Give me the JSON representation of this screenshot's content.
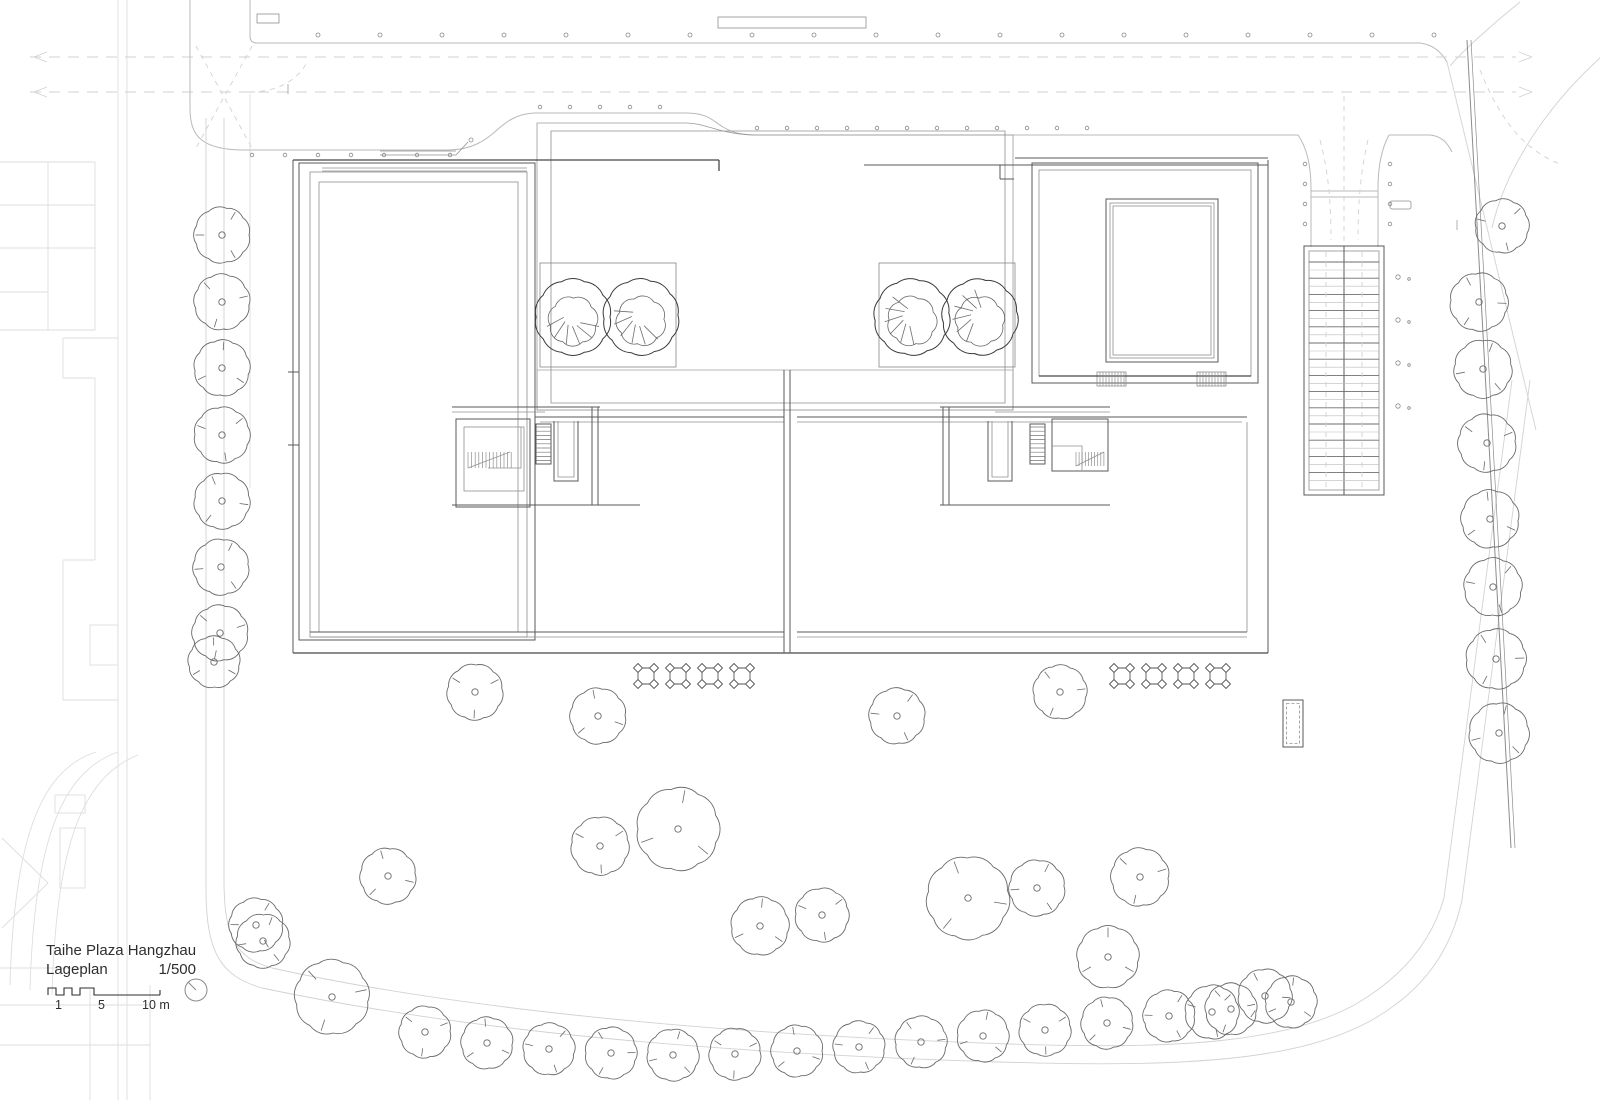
{
  "title_block": {
    "project": "Taihe Plaza Hangzhau",
    "drawing": "Lageplan",
    "scale": "1/500",
    "scale_ticks": [
      "1",
      "5",
      "10 m"
    ]
  },
  "colors": {
    "line_dark": "#5a5a5a",
    "line_mid": "#909090",
    "line_light": "#b9b9b9",
    "hatch_light": "#c6c6c6",
    "hatch_mid": "#9a9a9a",
    "panel_fill": "#b0b0b0",
    "band_fill": "#d7d7d7",
    "band_strip": "#eaeaea",
    "tree_line": "#6a6a6a",
    "tree_dark": "#474747",
    "tree_mid": "#8f8f8f",
    "dot": "#8a8a8a",
    "text": "#2e2e2e"
  },
  "site_plan": {
    "trees": {
      "street_left": [
        [
          222,
          235,
          27
        ],
        [
          222,
          302,
          27
        ],
        [
          222,
          368,
          27
        ],
        [
          222,
          435,
          27
        ],
        [
          222,
          501,
          27
        ],
        [
          221,
          567,
          27
        ],
        [
          220,
          633,
          27
        ],
        [
          214,
          662,
          25
        ]
      ],
      "street_right": [
        [
          1502,
          226,
          26
        ],
        [
          1479,
          302,
          28
        ],
        [
          1483,
          369,
          28
        ],
        [
          1487,
          443,
          28
        ],
        [
          1490,
          519,
          28
        ],
        [
          1493,
          587,
          28
        ],
        [
          1496,
          659,
          29
        ],
        [
          1499,
          733,
          29
        ]
      ],
      "scatter": [
        [
          475,
          692,
          27
        ],
        [
          598,
          716,
          27
        ],
        [
          897,
          716,
          27
        ],
        [
          1060,
          692,
          26
        ],
        [
          678,
          829,
          40
        ],
        [
          600,
          846,
          28
        ],
        [
          388,
          876,
          27
        ],
        [
          256,
          925,
          26
        ],
        [
          332,
          997,
          36
        ],
        [
          760,
          926,
          28
        ],
        [
          822,
          915,
          26
        ],
        [
          968,
          898,
          40
        ],
        [
          1037,
          888,
          27
        ],
        [
          1140,
          877,
          28
        ],
        [
          1108,
          957,
          30
        ],
        [
          1212,
          1012,
          26
        ],
        [
          1265,
          996,
          26
        ],
        [
          263,
          941,
          26
        ]
      ],
      "bottom_row": [
        [
          425,
          1032,
          25
        ],
        [
          487,
          1043,
          25
        ],
        [
          549,
          1049,
          25
        ],
        [
          611,
          1053,
          25
        ],
        [
          673,
          1055,
          25
        ],
        [
          735,
          1054,
          25
        ],
        [
          797,
          1051,
          25
        ],
        [
          859,
          1047,
          25
        ],
        [
          921,
          1042,
          25
        ],
        [
          983,
          1036,
          25
        ],
        [
          1045,
          1030,
          25
        ],
        [
          1107,
          1023,
          25
        ],
        [
          1169,
          1016,
          25
        ],
        [
          1231,
          1009,
          25
        ],
        [
          1291,
          1002,
          25
        ]
      ],
      "courtyard_dark": [
        [
          573,
          317,
          37
        ],
        [
          641,
          317,
          37
        ],
        [
          912,
          317,
          37
        ],
        [
          980,
          317,
          37
        ]
      ]
    },
    "planting_markers": {
      "y": 676,
      "x_positions": [
        646,
        678,
        710,
        742,
        1122,
        1154,
        1186,
        1218
      ]
    },
    "dot_rows": [
      {
        "y": 35,
        "x0": 318,
        "x1": 1442,
        "step": 62,
        "r": 2
      },
      {
        "y": 155,
        "x0": 252,
        "x1": 450,
        "step": 33,
        "r": 1.8
      },
      {
        "y": 107,
        "x0": 540,
        "x1": 688,
        "step": 30,
        "r": 1.8
      },
      {
        "y": 128,
        "x0": 757,
        "x1": 1097,
        "step": 30,
        "r": 1.8
      },
      {
        "y": 820,
        "x0": 237,
        "x1": 1272,
        "step": 23,
        "r": 1.2,
        "fill": 1
      }
    ],
    "dot_cols": [
      {
        "x": 1305,
        "y0": 164,
        "y1": 226,
        "step": 20,
        "r": 1.8
      },
      {
        "x": 1390,
        "y0": 164,
        "y1": 226,
        "step": 20,
        "r": 1.8
      },
      {
        "x": 1398,
        "y0": 277,
        "y1": 408,
        "step": 43,
        "r": 2.2
      },
      {
        "x": 1409,
        "y0": 279,
        "y1": 410,
        "step": 43,
        "r": 1.3
      }
    ]
  }
}
